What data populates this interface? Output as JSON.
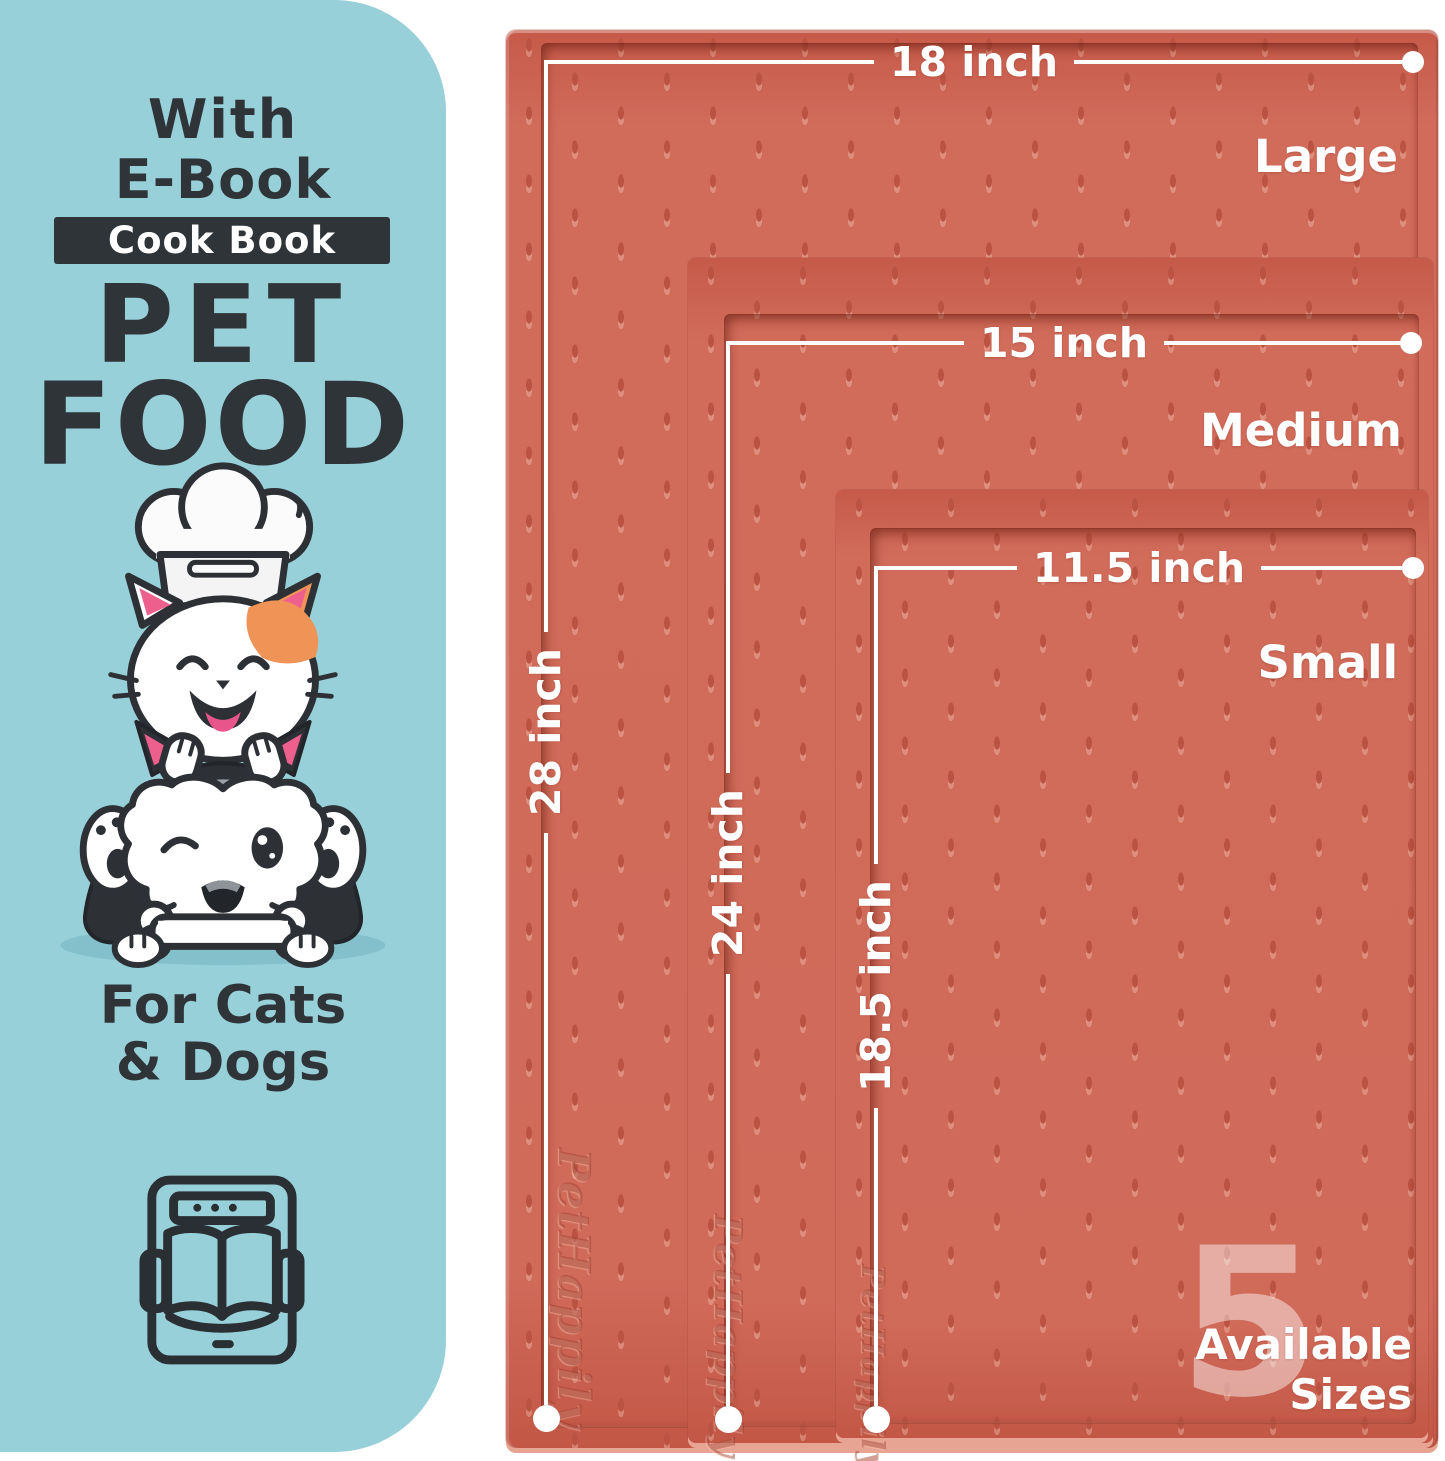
{
  "left_panel": {
    "line1": "With",
    "line2": "E-Book",
    "badge": "Cook Book",
    "title_line1": "PET",
    "title_line2": "FOOD",
    "audience_line1": "For Cats",
    "audience_line2": "& Dogs"
  },
  "mats": {
    "brand_embossed": "PetHappily",
    "sizes": [
      {
        "label": "Large",
        "width_label": "18 inch",
        "height_label": "28 inch"
      },
      {
        "label": "Medium",
        "width_label": "15 inch",
        "height_label": "24 inch"
      },
      {
        "label": "Small",
        "width_label": "11.5 inch",
        "height_label": "18.5 inch"
      }
    ],
    "badge": {
      "count": "5",
      "line1": "Available",
      "line2": "Sizes"
    }
  },
  "colors": {
    "panel_blue": "#98d0da",
    "text_charcoal": "#2f3438",
    "mat_surface": "#ce6454",
    "dimension_white": "#ffffff",
    "patch_orange": "#ef9357",
    "ear_pink": "#ed5f8c"
  },
  "icons": {
    "illustration": "cat-chef-and-husky-with-bone",
    "ebook": "ebook-tablet-open-book-icon"
  }
}
